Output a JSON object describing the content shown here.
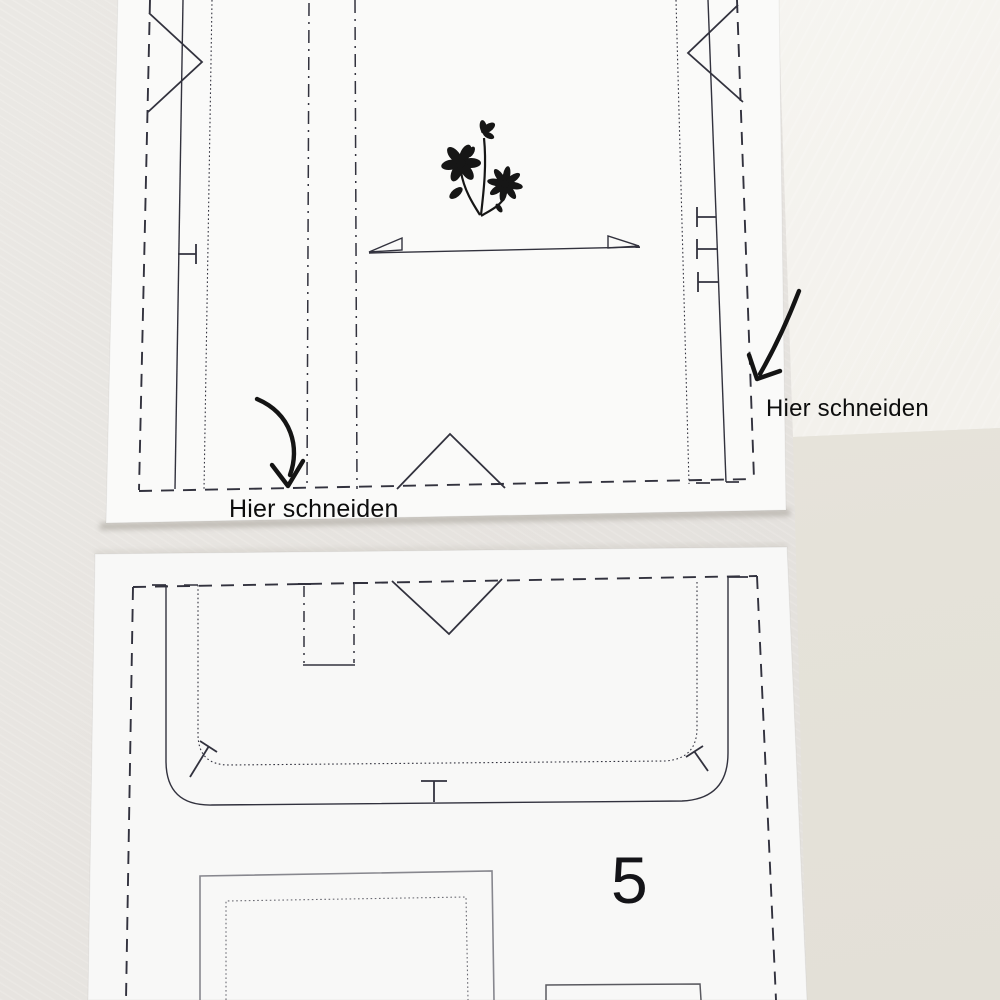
{
  "annotations": {
    "left_cut_label": "Hier schneiden",
    "right_cut_label": "Hier schneiden"
  },
  "sheets": {
    "bottom_sheet": {
      "page_number": "5"
    }
  },
  "icons": {
    "flower_motif": "flower-illustration",
    "left_arrow": "curved-arrow-down",
    "right_arrow": "curved-arrow-down"
  },
  "colors": {
    "desk": "#e9e6e1",
    "desk_bright": "#f4f3ee",
    "desk_beige": "#e5e2d9",
    "paper": "#fafaf9",
    "print_ink": "#32323e",
    "annotation_ink": "#141414"
  }
}
